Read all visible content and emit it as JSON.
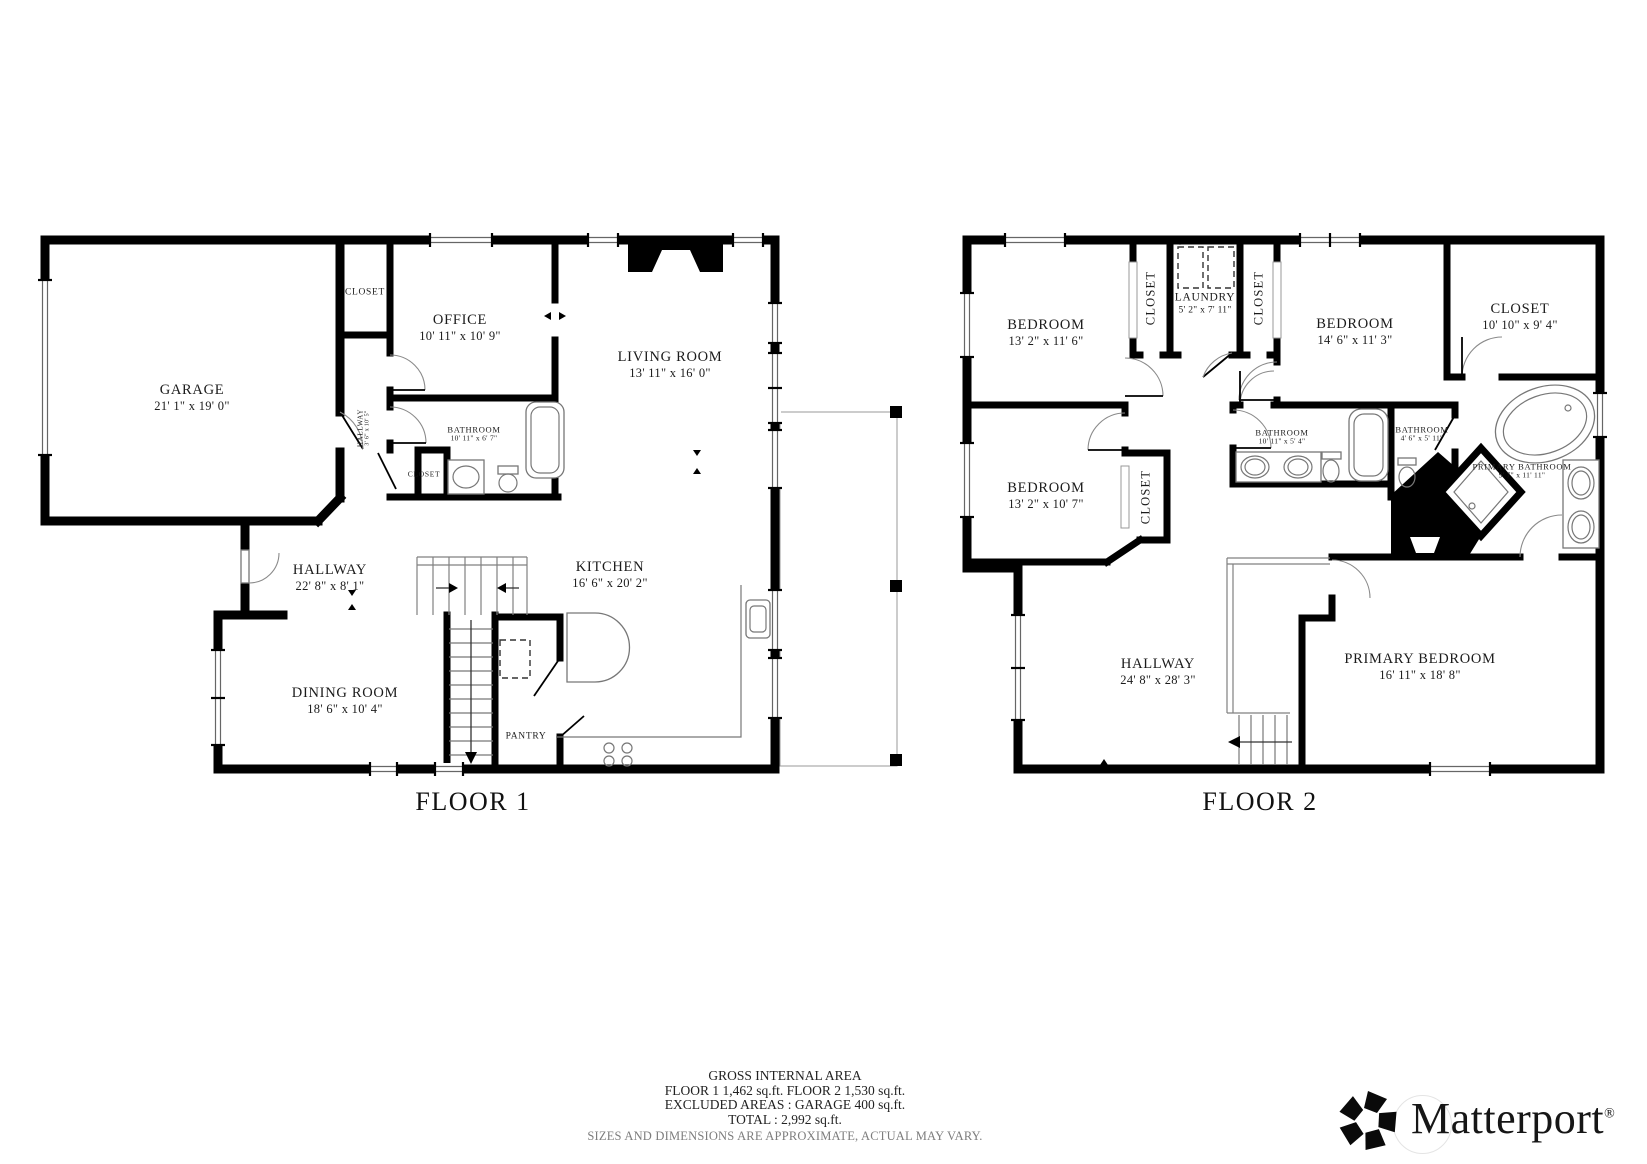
{
  "floor1": {
    "label": "FLOOR 1",
    "rooms": [
      {
        "name": "GARAGE",
        "dims": "21' 1\" x 19' 0\""
      },
      {
        "name": "CLOSET",
        "dims": ""
      },
      {
        "name": "OFFICE",
        "dims": "10' 11\" x 10' 9\""
      },
      {
        "name": "LIVING ROOM",
        "dims": "13' 11\" x 16' 0\""
      },
      {
        "name": "HALLWAY",
        "dims": "3' 6\" x 10' 5\""
      },
      {
        "name": "BATHROOM",
        "dims": "10' 11\" x 6' 7\""
      },
      {
        "name": "CLOSET",
        "dims": ""
      },
      {
        "name": "HALLWAY",
        "dims": "22' 8\" x 8' 1\""
      },
      {
        "name": "KITCHEN",
        "dims": "16' 6\" x 20' 2\""
      },
      {
        "name": "DINING ROOM",
        "dims": "18' 6\" x 10' 4\""
      },
      {
        "name": "PANTRY",
        "dims": ""
      }
    ]
  },
  "floor2": {
    "label": "FLOOR 2",
    "rooms": [
      {
        "name": "BEDROOM",
        "dims": "13' 2\" x 11' 6\""
      },
      {
        "name": "CLOSET",
        "dims": ""
      },
      {
        "name": "LAUNDRY",
        "dims": "5' 2\" x 7' 11\""
      },
      {
        "name": "CLOSET",
        "dims": ""
      },
      {
        "name": "BEDROOM",
        "dims": "14' 6\" x 11' 3\""
      },
      {
        "name": "CLOSET",
        "dims": "10' 10\" x 9' 4\""
      },
      {
        "name": "BEDROOM",
        "dims": "13' 2\" x 10' 7\""
      },
      {
        "name": "CLOSET",
        "dims": ""
      },
      {
        "name": "BATHROOM",
        "dims": "10' 11\" x 5' 4\""
      },
      {
        "name": "BATHROOM",
        "dims": "4' 6\" x 5' 11\""
      },
      {
        "name": "PRIMARY BATHROOM",
        "dims": "9' 7\" x 11' 11\""
      },
      {
        "name": "HALLWAY",
        "dims": "24' 8\" x 28' 3\""
      },
      {
        "name": "PRIMARY BEDROOM",
        "dims": "16' 11\" x 18' 8\""
      }
    ]
  },
  "footer": {
    "title": "GROSS INTERNAL AREA",
    "areas": "FLOOR 1 1,462 sq.ft. FLOOR 2 1,530 sq.ft.",
    "excluded": "EXCLUDED AREAS : GARAGE 400 sq.ft.",
    "total": "TOTAL : 2,992 sq.ft.",
    "disclaimer": "SIZES AND DIMENSIONS ARE APPROXIMATE, ACTUAL MAY VARY."
  },
  "brand": {
    "name": "Matterport",
    "registered": "®"
  }
}
